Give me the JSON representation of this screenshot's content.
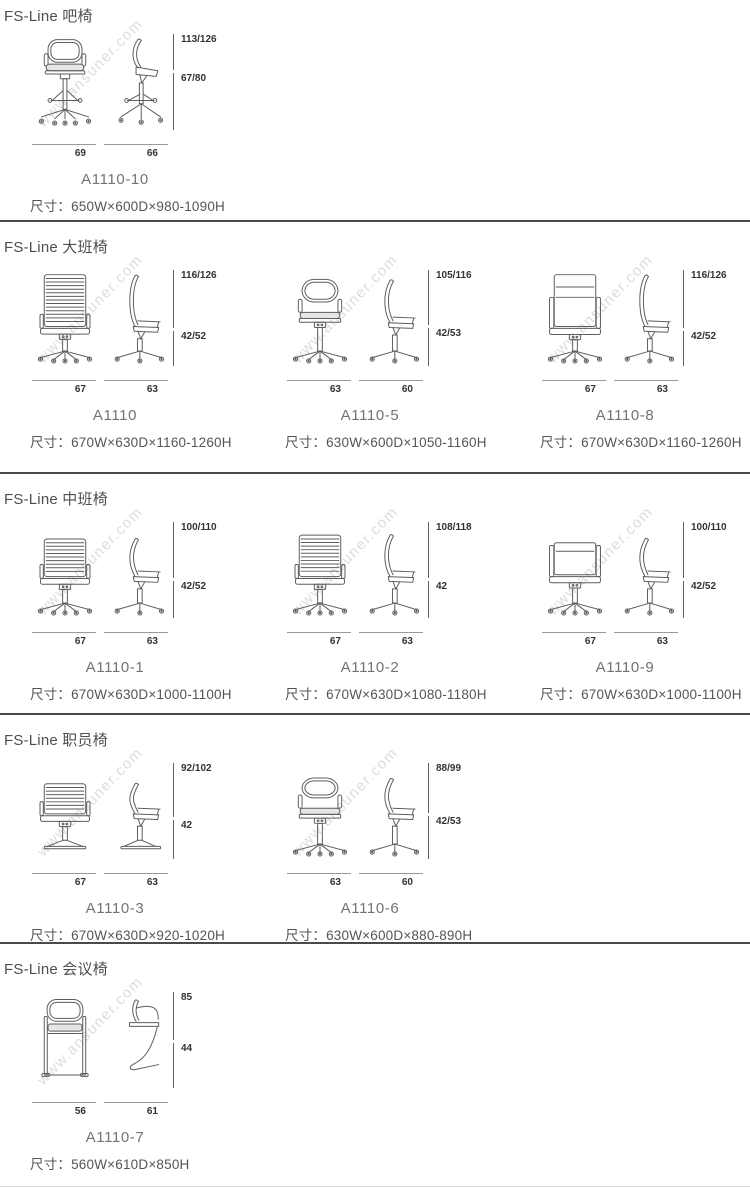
{
  "watermark": "www.ansuner.com",
  "divider_color": "#4a4a4a",
  "sections": [
    {
      "title": "FS-Line 吧椅",
      "products": [
        {
          "model": "A1110-10",
          "size": "尺寸：650W×600D×980-1090H",
          "height_total": "113/126",
          "height_seat": "67/80",
          "width_front": "69",
          "width_side": "66",
          "front_view": "bar-stool-front",
          "side_view": "bar-stool-side",
          "seat_level": 0.38
        }
      ]
    },
    {
      "title": "FS-Line 大班椅",
      "products": [
        {
          "model": "A1110",
          "size": "尺寸：670W×630D×1160-1260H",
          "height_total": "116/126",
          "height_seat": "42/52",
          "width_front": "67",
          "width_side": "63",
          "front_view": "ribbed-high-back-front",
          "side_view": "high-back-side",
          "seat_level": 0.6
        },
        {
          "model": "A1110-5",
          "size": "尺寸：630W×600D×1050-1160H",
          "height_total": "105/116",
          "height_seat": "42/53",
          "width_front": "63",
          "width_side": "60",
          "front_view": "smooth-high-back-front",
          "side_view": "smooth-high-back-side",
          "seat_level": 0.57
        },
        {
          "model": "A1110-8",
          "size": "尺寸：670W×630D×1160-1260H",
          "height_total": "116/126",
          "height_seat": "42/52",
          "width_front": "67",
          "width_side": "63",
          "front_view": "panel-high-back-front",
          "side_view": "high-back-side",
          "seat_level": 0.6
        }
      ]
    },
    {
      "title": "FS-Line 中班椅",
      "products": [
        {
          "model": "A1110-1",
          "size": "尺寸：670W×630D×1000-1100H",
          "height_total": "100/110",
          "height_seat": "42/52",
          "width_front": "67",
          "width_side": "63",
          "front_view": "ribbed-mid-back-front",
          "side_view": "mid-back-side",
          "seat_level": 0.58
        },
        {
          "model": "A1110-2",
          "size": "尺寸：670W×630D×1080-1180H",
          "height_total": "108/118",
          "height_seat": "42",
          "width_front": "67",
          "width_side": "63",
          "front_view": "ribbed-tall-mid-back-front",
          "side_view": "tall-mid-back-side",
          "seat_level": 0.58
        },
        {
          "model": "A1110-9",
          "size": "尺寸：670W×630D×1000-1100H",
          "height_total": "100/110",
          "height_seat": "42/52",
          "width_front": "67",
          "width_side": "63",
          "front_view": "panel-mid-back-front",
          "side_view": "mid-back-side",
          "seat_level": 0.58
        }
      ]
    },
    {
      "title": "FS-Line 职员椅",
      "products": [
        {
          "model": "A1110-3",
          "size": "尺寸：670W×630D×920-1020H",
          "height_total": "92/102",
          "height_seat": "42",
          "width_front": "67",
          "width_side": "63",
          "front_view": "ribbed-back-sled-front",
          "side_view": "sled-base-side",
          "seat_level": 0.56
        },
        {
          "model": "A1110-6",
          "size": "尺寸：630W×600D×880-890H",
          "height_total": "88/99",
          "height_seat": "42/53",
          "width_front": "63",
          "width_side": "60",
          "front_view": "smooth-low-back-front",
          "side_view": "low-back-side",
          "seat_level": 0.52
        }
      ]
    },
    {
      "title": "FS-Line 会议椅",
      "products": [
        {
          "model": "A1110-7",
          "size": "尺寸：560W×610D×850H",
          "height_total": "85",
          "height_seat": "44",
          "width_front": "56",
          "width_side": "61",
          "front_view": "cantilever-front",
          "side_view": "cantilever-side",
          "seat_level": 0.5
        }
      ]
    }
  ]
}
